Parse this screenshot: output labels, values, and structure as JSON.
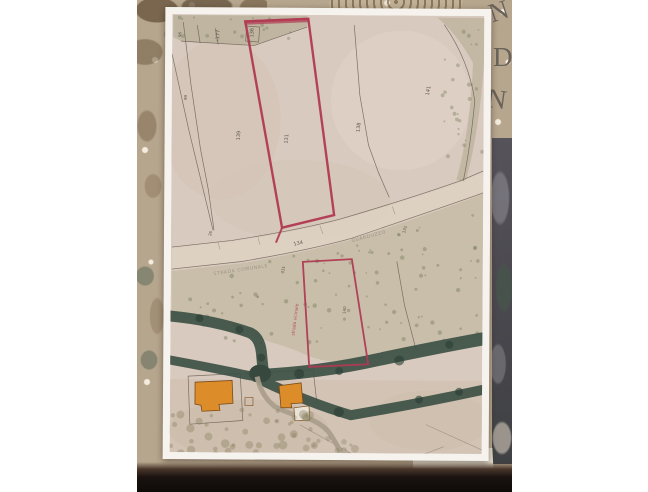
{
  "photo": {
    "tablecloth_letters": [
      "N",
      "D",
      "N"
    ],
    "colors": {
      "canvas": "#ffffff",
      "tablecloth": "#b7a68e",
      "lace": "#6e5a42",
      "letters": "#6a635a",
      "neighbor_photo": "#4d4b52",
      "table_shadow": "#14100d"
    }
  },
  "map": {
    "colors": {
      "paper": "#f6f3ee",
      "land": "#d9cabf",
      "boundary": "#6b5f52",
      "road_fill": "#ddd2c2",
      "vegetation": "#b7af93",
      "tree_band": "#3e5246",
      "building": "#dd8c2a",
      "red_outline": "#b03a52"
    },
    "parcel_numbers": [
      {
        "label": "96",
        "x": 180,
        "y": 38,
        "r": -88
      },
      {
        "label": "177",
        "x": 218,
        "y": 40,
        "r": -88
      },
      {
        "label": "136",
        "x": 252,
        "y": 38,
        "r": -88
      },
      {
        "label": "99",
        "x": 186,
        "y": 101,
        "r": -88
      },
      {
        "label": "139",
        "x": 239,
        "y": 141,
        "r": -85
      },
      {
        "label": "131",
        "x": 287,
        "y": 144,
        "r": -85
      },
      {
        "label": "138",
        "x": 359,
        "y": 132,
        "r": -85
      },
      {
        "label": "141",
        "x": 428,
        "y": 95,
        "r": -80
      },
      {
        "label": "26",
        "x": 211,
        "y": 237,
        "r": -75
      },
      {
        "label": "131",
        "x": 405,
        "y": 233,
        "r": -75
      },
      {
        "label": "431",
        "x": 284,
        "y": 274,
        "r": -80
      },
      {
        "label": "140",
        "x": 346,
        "y": 314,
        "r": -85
      }
    ],
    "road": {
      "number": "134",
      "name_left": "STRADA COMUNALE",
      "name_right": "GUARDUZZO"
    },
    "red_annotation": "strada vicinale"
  }
}
